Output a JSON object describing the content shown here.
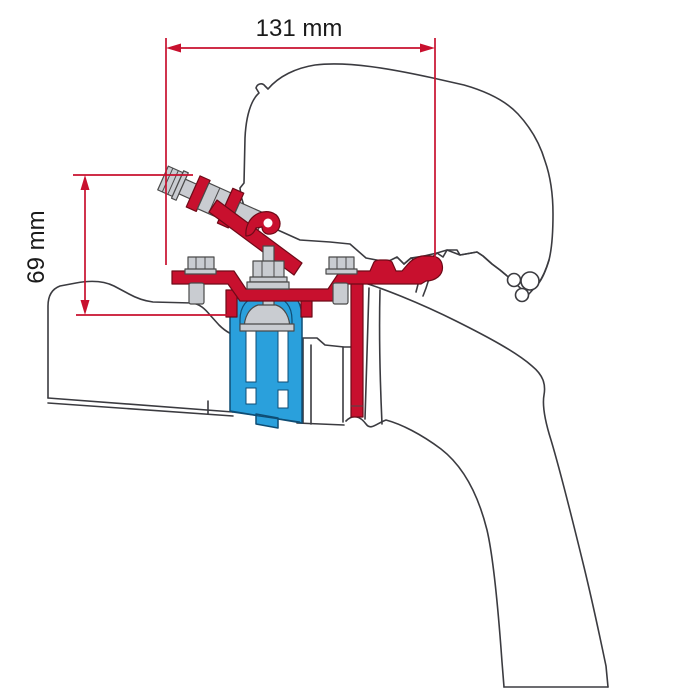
{
  "diagram": {
    "title": "Awning adapter bracket mounting diagram (side cross-section)",
    "dimensions": {
      "width": {
        "label": "131 mm"
      },
      "height": {
        "label": "69 mm"
      }
    },
    "parts": [
      "awning-case-profile",
      "vehicle-roof-profile",
      "red-adapter-bracket",
      "blue-mounting-bracket",
      "clamp-bolt-assembly",
      "mounting-bolts"
    ],
    "colors": {
      "bracket_red": "#C8102E",
      "bracket_blue": "#2AA0DC",
      "outline_gray": "#3B3B40",
      "hardware_gray": "#C9CCD1",
      "dimension_red": "#C8102E",
      "text_black": "#1A1A1A",
      "background": "#FFFFFF"
    }
  }
}
